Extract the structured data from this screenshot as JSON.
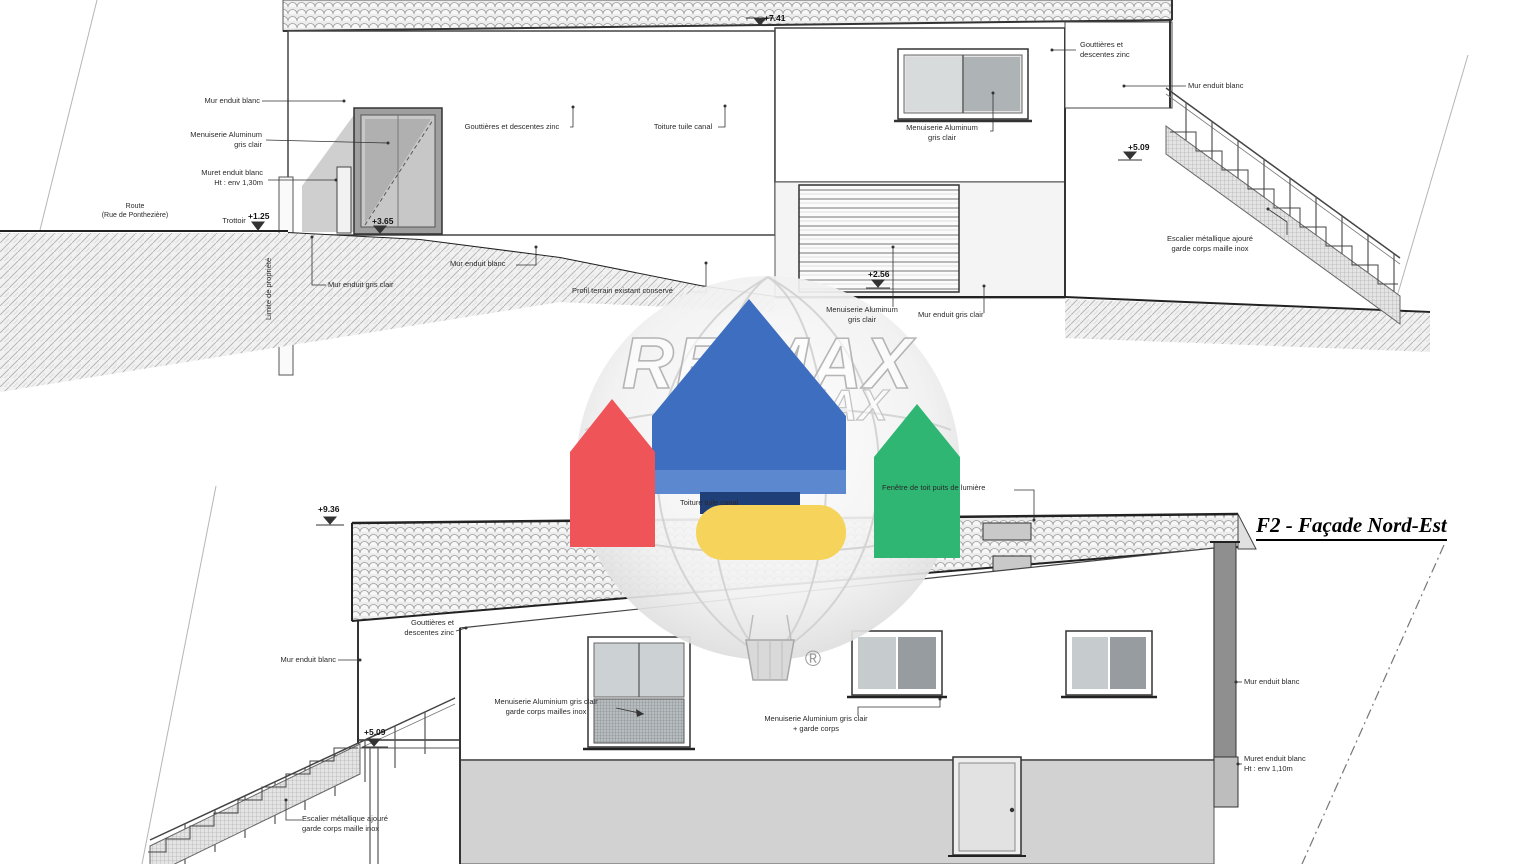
{
  "watermark": {
    "brand": "RE/MAX",
    "brand_secondary": "RE/MAX",
    "registered": "®"
  },
  "colors": {
    "remax_red": "#ef5459",
    "remax_blue": "#3e6ec0",
    "remax_navy": "#1f3f78",
    "remax_green": "#2fb673",
    "remax_yellow": "#f6d45c",
    "linework": "#333333"
  },
  "top_elevation": {
    "levels": {
      "ridge": "+7.41",
      "sidewalk": "+1.25",
      "door": "+3.65",
      "garage": "+2.56",
      "stair_top": "+5.09"
    },
    "labels": {
      "mur_enduit_blanc_left": "Mur enduit blanc",
      "menuiserie_alu_left": "Menuiserie Aluminum\ngris clair",
      "muret_left": "Muret enduit blanc\nHt : env 1,30m",
      "route": "Route\n(Rue de Ponthezière)",
      "trottoir": "Trottoir",
      "limite_propriete": "Limite de propriété",
      "gouttieres_centre": "Gouttières et descentes zinc",
      "toiture": "Toiture tuile canal",
      "menuiserie_fenetre_droite": "Menuiserie Aluminum\ngris clair",
      "gouttieres_droite": "Gouttières et\ndescentes zinc",
      "mur_enduit_blanc_droite": "Mur enduit blanc",
      "escalier": "Escalier métallique ajouré\ngarde corps maille inox",
      "mur_gris_gauche": "Mur enduit gris clair",
      "mur_blanc_centre": "Mur enduit blanc",
      "profil_terrain": "Profil terrain existant conservé",
      "menuiserie_garage": "Menuiserie Aluminum\ngris clair",
      "mur_gris_droite": "Mur enduit gris clair"
    }
  },
  "bottom_elevation": {
    "title": "F2 - Façade Nord-Est",
    "levels": {
      "ridge": "+9.36",
      "stair_top": "+5.09"
    },
    "labels": {
      "toiture": "Toiture tuile canal",
      "fenetre_toit": "Fenêtre de toit puits de lumière",
      "gouttieres": "Gouttières et\ndescentes zinc",
      "mur_blanc_gauche": "Mur enduit blanc",
      "menuiserie_garde_corps_mailles": "Menuiserie Aluminium gris clair\ngarde corps mailles inox",
      "menuiserie_garde_corps": "Menuiserie Aluminium gris clair\n+ garde corps",
      "escalier": "Escalier métallique ajouré\ngarde corps maille inox",
      "mur_blanc_droite": "Mur enduit blanc",
      "muret_droite": "Muret enduit blanc\nHt : env 1,10m"
    }
  }
}
